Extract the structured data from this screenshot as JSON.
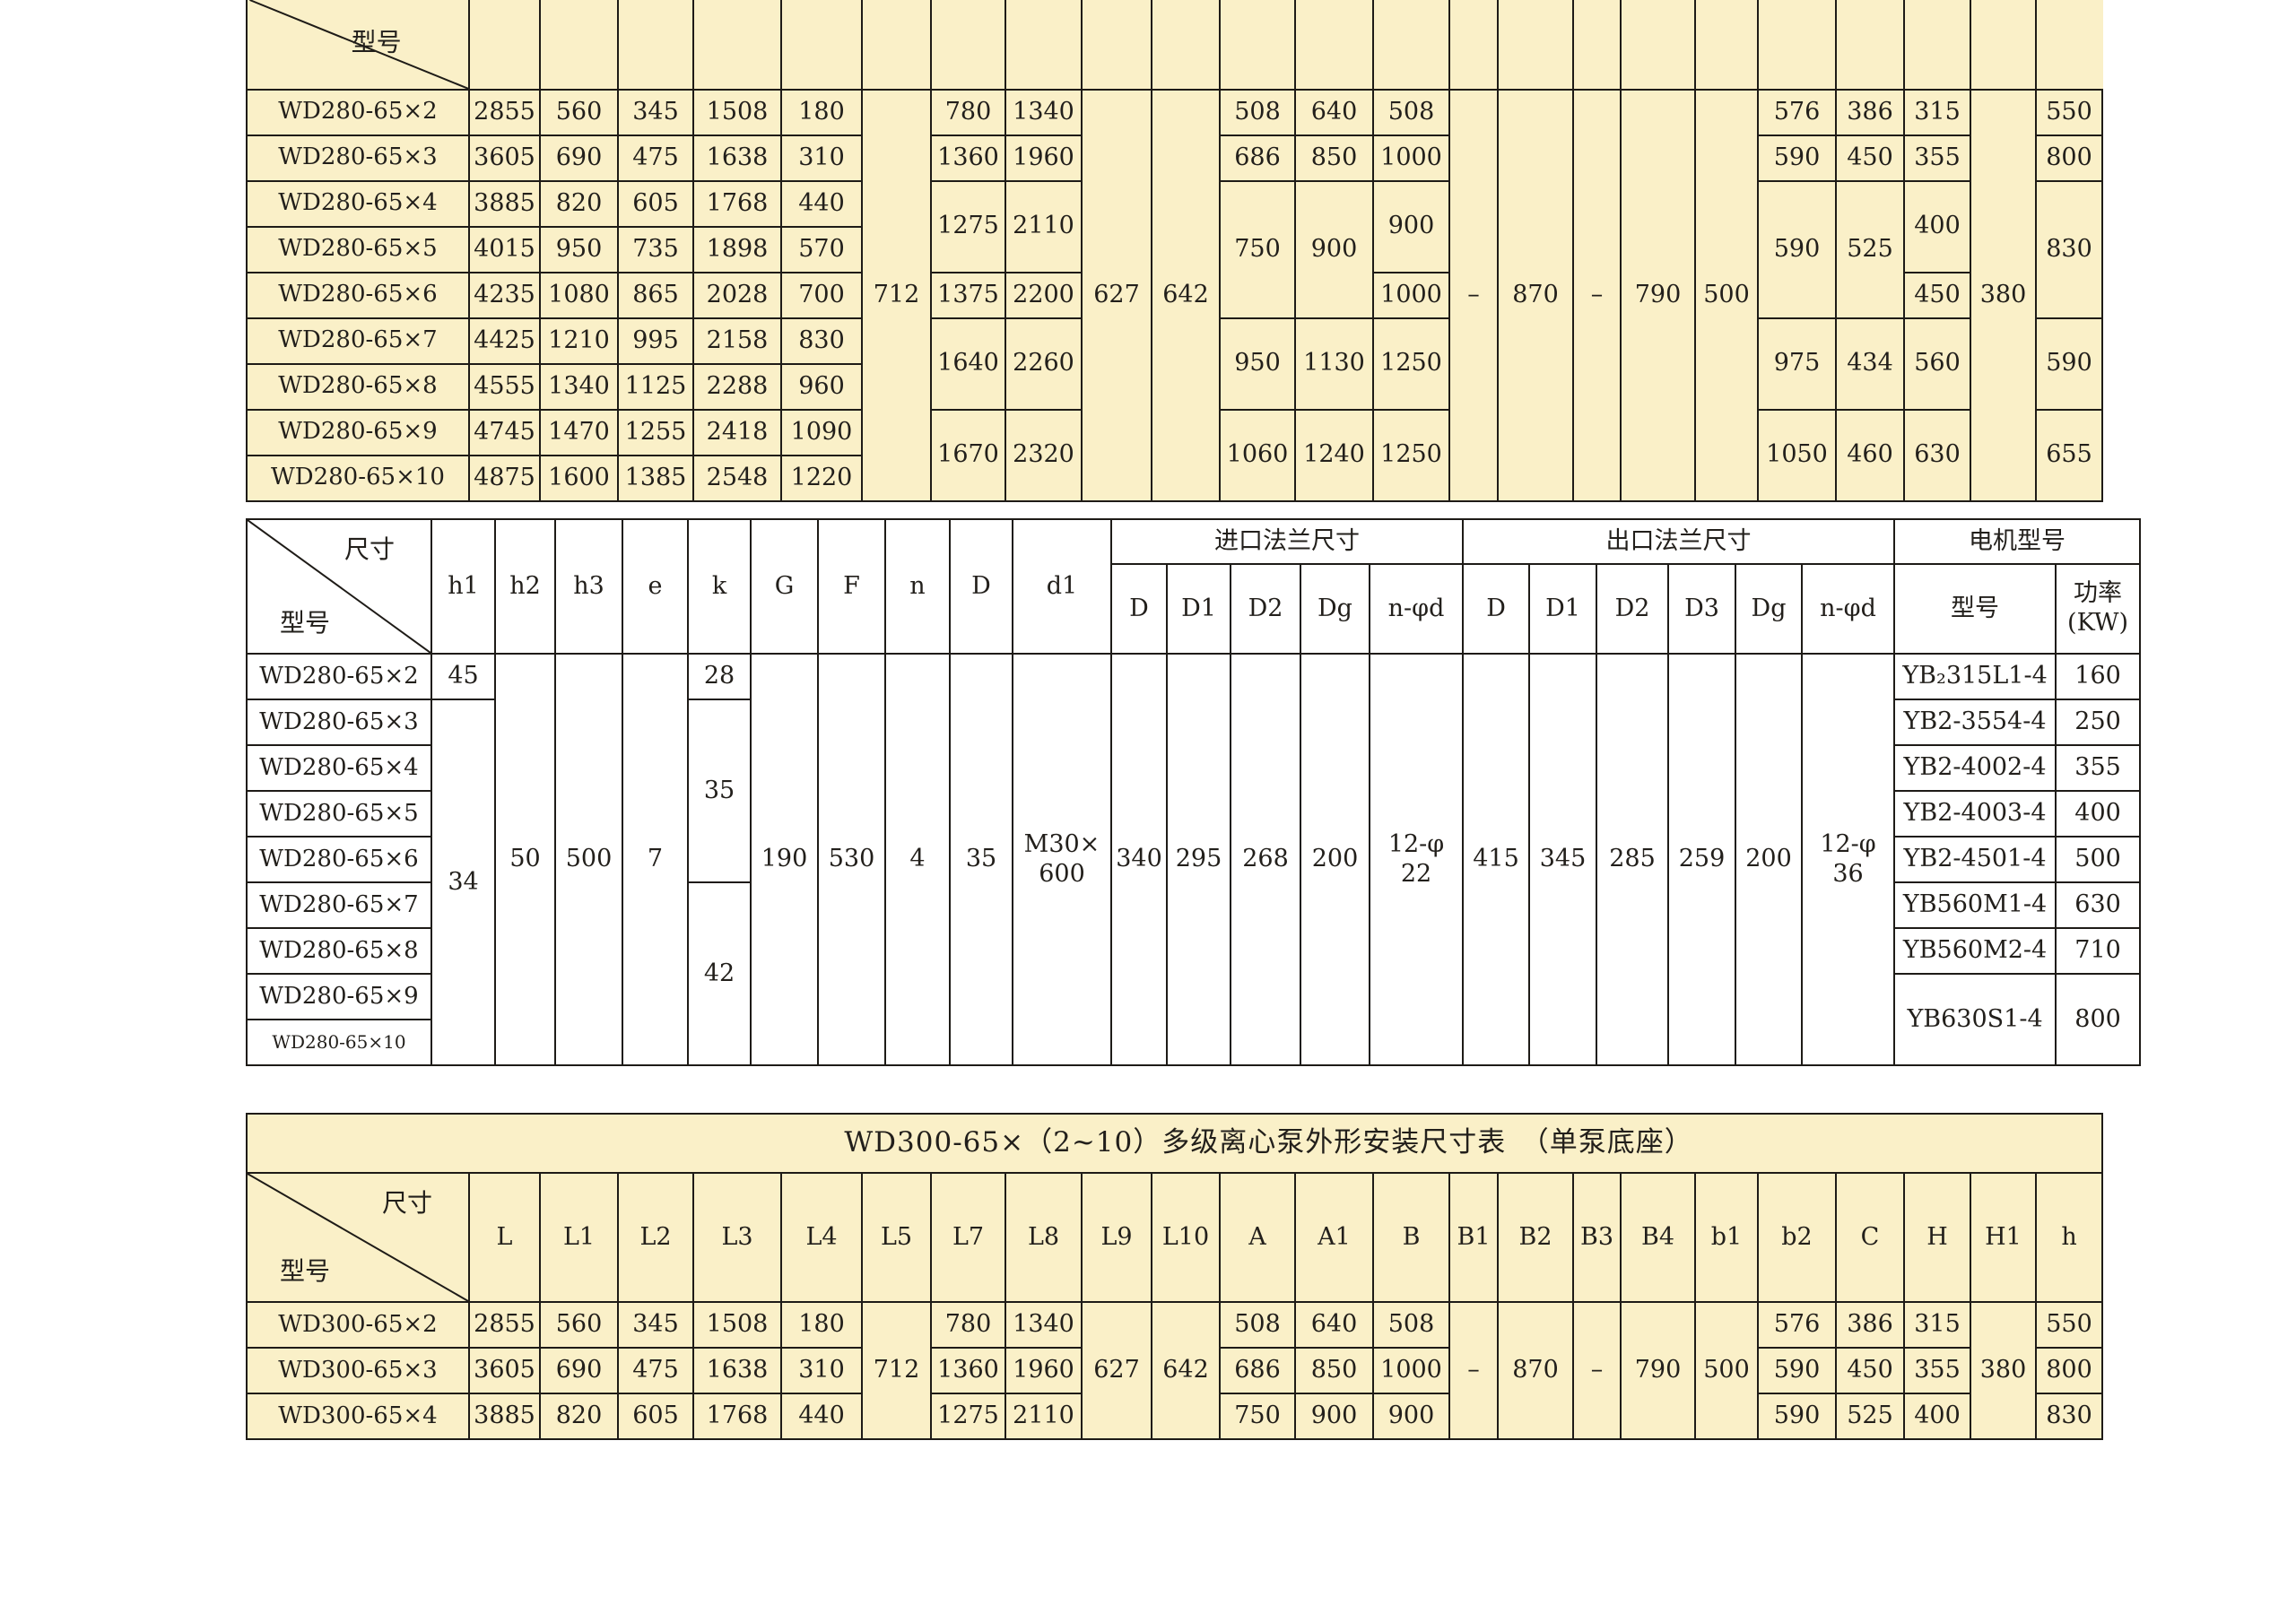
{
  "palette": {
    "table_bg": "#faf0c8",
    "mid_table_bg": "#ffffff",
    "border": "#1e1b17",
    "text": "#221f1b"
  },
  "t1": {
    "corner_model": "型号",
    "rows": [
      [
        "WD280-65×2",
        "2855",
        "560",
        "345",
        "1508",
        "180",
        "712",
        "780",
        "1340",
        "627",
        "642",
        "508",
        "640",
        "508",
        "–",
        "870",
        "–",
        "790",
        "500",
        "576",
        "386",
        "315",
        "380",
        "550"
      ],
      [
        "WD280-65×3",
        "3605",
        "690",
        "475",
        "1638",
        "310",
        "1360",
        "1960",
        "686",
        "850",
        "1000",
        "590",
        "450",
        "355",
        "800"
      ],
      [
        "WD280-65×4",
        "3885",
        "820",
        "605",
        "1768",
        "440",
        "1275",
        "2110",
        "750",
        "900",
        "900",
        "590",
        "525",
        "400",
        "830"
      ],
      [
        "WD280-65×5",
        "4015",
        "950",
        "735",
        "1898",
        "570"
      ],
      [
        "WD280-65×6",
        "4235",
        "1080",
        "865",
        "2028",
        "700",
        "1375",
        "2200",
        "1000",
        "450"
      ],
      [
        "WD280-65×7",
        "4425",
        "1210",
        "995",
        "2158",
        "830",
        "1640",
        "2260",
        "950",
        "1130",
        "1250",
        "975",
        "434",
        "560",
        "590"
      ],
      [
        "WD280-65×8",
        "4555",
        "1340",
        "1125",
        "2288",
        "960"
      ],
      [
        "WD280-65×9",
        "4745",
        "1470",
        "1255",
        "2418",
        "1090",
        "1670",
        "2320",
        "1060",
        "1240",
        "1250",
        "1050",
        "460",
        "630",
        "655"
      ],
      [
        "WD280-65×10",
        "4875",
        "1600",
        "1385",
        "2548",
        "1220"
      ]
    ]
  },
  "t2": {
    "corner_size": "尺寸",
    "corner_model": "型号",
    "col_headers": [
      "h1",
      "h2",
      "h3",
      "e",
      "k",
      "G",
      "F",
      "n",
      "D",
      "d1"
    ],
    "group_inlet": "进口法兰尺寸",
    "group_outlet": "出口法兰尺寸",
    "group_motor": "电机型号",
    "inlet_sub": [
      "D",
      "D1",
      "D2",
      "Dg",
      "n-φd"
    ],
    "outlet_sub": [
      "D",
      "D1",
      "D2",
      "D3",
      "Dg",
      "n-φd"
    ],
    "motor_sub": [
      "型号",
      "功率\n(KW)"
    ],
    "rows": [
      [
        "WD280-65×2",
        "45",
        "50",
        "500",
        "7",
        "28",
        "190",
        "530",
        "4",
        "35",
        "M30×\n600",
        "340",
        "295",
        "268",
        "200",
        "12-φ\n22",
        "415",
        "345",
        "285",
        "259",
        "200",
        "12-φ\n36",
        "YB₂315L1-4",
        "160"
      ],
      [
        "WD280-65×3",
        "34",
        "35",
        "YB2-3554-4",
        "250"
      ],
      [
        "WD280-65×4",
        "YB2-4002-4",
        "355"
      ],
      [
        "WD280-65×5",
        "YB2-4003-4",
        "400"
      ],
      [
        "WD280-65×6",
        "YB2-4501-4",
        "500"
      ],
      [
        "WD280-65×7",
        "42",
        "YB560M1-4",
        "630"
      ],
      [
        "WD280-65×8",
        "YB560M2-4",
        "710"
      ],
      [
        "WD280-65×9",
        "YB630S1-4",
        "800"
      ],
      [
        "WD280-65×10"
      ]
    ]
  },
  "t3": {
    "title": "WD300-65×（2~10）多级离心泵外形安装尺寸表　（单泵底座）",
    "corner_size": "尺寸",
    "corner_model": "型号",
    "col_headers": [
      "L",
      "L1",
      "L2",
      "L3",
      "L4",
      "L5",
      "L7",
      "L8",
      "L9",
      "L10",
      "A",
      "A1",
      "B",
      "B1",
      "B2",
      "B3",
      "B4",
      "b1",
      "b2",
      "C",
      "H",
      "H1",
      "h"
    ],
    "rows": [
      [
        "WD300-65×2",
        "2855",
        "560",
        "345",
        "1508",
        "180",
        "712",
        "780",
        "1340",
        "627",
        "642",
        "508",
        "640",
        "508",
        "–",
        "870",
        "–",
        "790",
        "500",
        "576",
        "386",
        "315",
        "380",
        "550"
      ],
      [
        "WD300-65×3",
        "3605",
        "690",
        "475",
        "1638",
        "310",
        "1360",
        "1960",
        "686",
        "850",
        "1000",
        "590",
        "450",
        "355",
        "800"
      ],
      [
        "WD300-65×4",
        "3885",
        "820",
        "605",
        "1768",
        "440",
        "1275",
        "2110",
        "750",
        "900",
        "900",
        "590",
        "525",
        "400",
        "830"
      ]
    ]
  }
}
